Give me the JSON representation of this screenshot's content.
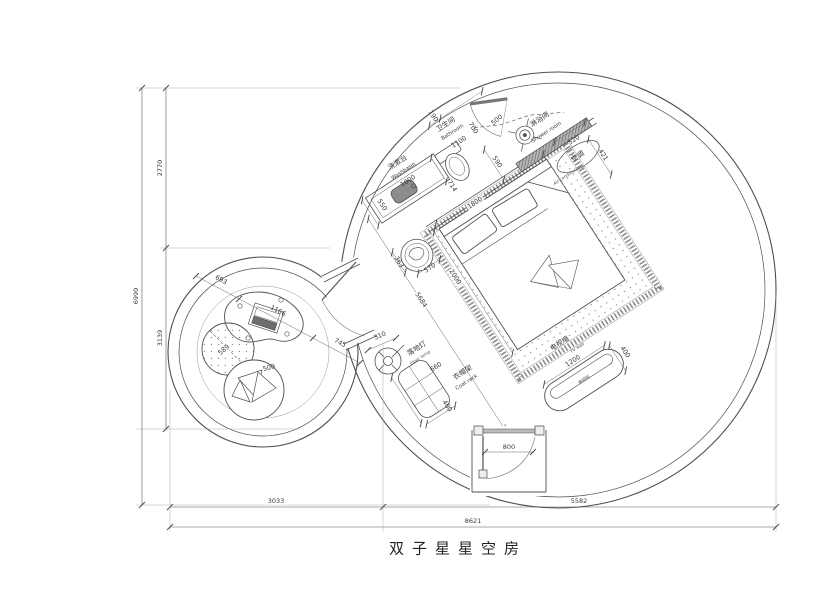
{
  "title": "双子星星空房",
  "dims": {
    "total_height": "6990",
    "height_top": "2770",
    "height_bottom": "3139",
    "bottom_left": "3033",
    "bottom_right": "5582",
    "bottom_total": "8621"
  },
  "entry": {
    "door_width": "800"
  },
  "washbasin": {
    "zh": "洗漱台",
    "en": "Washbasin",
    "width": "1000",
    "depth": "550",
    "offset": "714"
  },
  "bathroom": {
    "zh": "卫生间",
    "en": "Bathroom",
    "width": "1100",
    "jog": "190",
    "door": "700",
    "shower_door": "500",
    "d590": "590"
  },
  "shower": {
    "zh": "淋浴间",
    "en": "Shower room",
    "d520": "520",
    "d421": "421"
  },
  "ac": {
    "zh": "空调",
    "en": "Air-conditioning"
  },
  "bed": {
    "width": "1800",
    "length": "2000",
    "diag": "5684",
    "stool_offset": "363",
    "stool_width": "570"
  },
  "tv": {
    "zh": "电视墙",
    "en": "TV wall",
    "cabinet": "电视柜",
    "length": "1200",
    "depth": "400"
  },
  "lamp": {
    "zh": "落地灯",
    "en": "Floor lamp",
    "d310": "310"
  },
  "rack": {
    "zh": "衣帽架",
    "en": "Coat rack",
    "length": "660",
    "depth": "400"
  },
  "lounge": {
    "d693": "693",
    "d1166": "1166",
    "d745": "745",
    "stool": "589",
    "beanbag": "500"
  }
}
